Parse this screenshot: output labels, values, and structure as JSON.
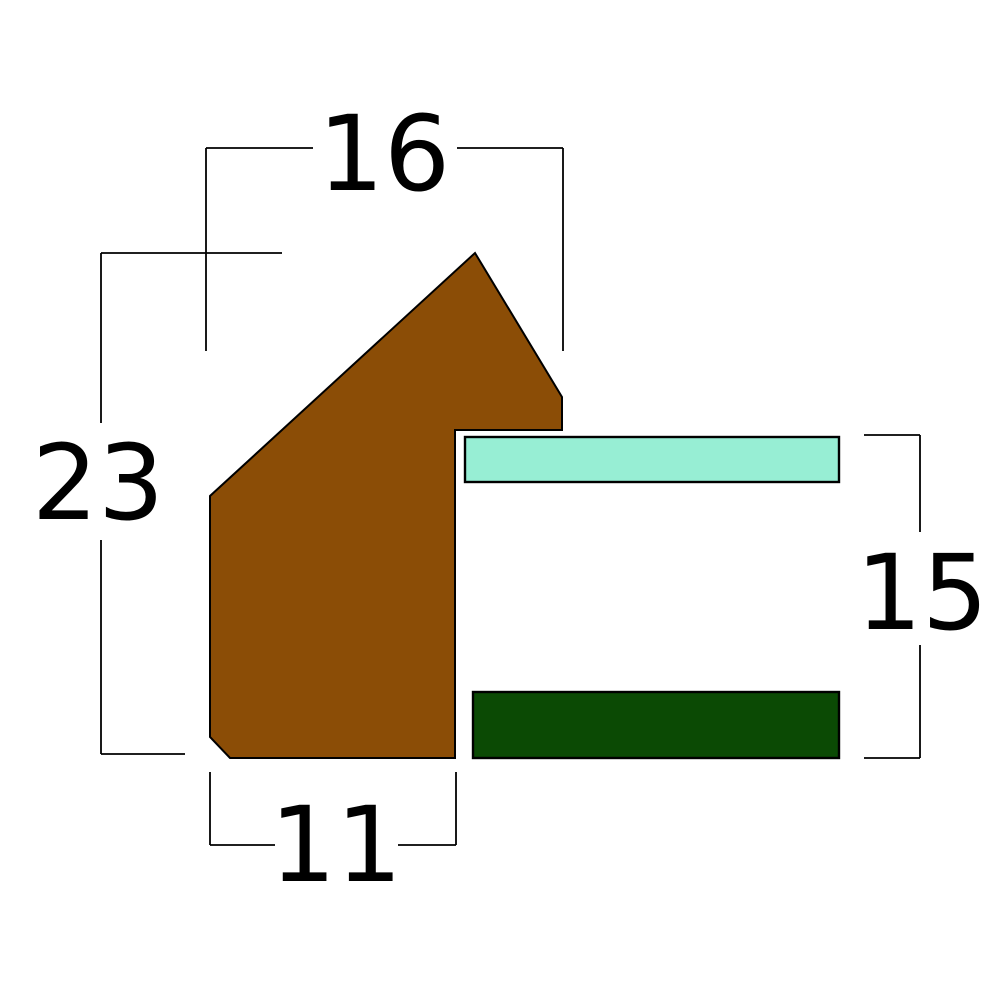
{
  "page": {
    "title": "Frame moulding cross-section with dimensions"
  },
  "canvas": {
    "width": 1000,
    "height": 1000,
    "background": "#ffffff"
  },
  "colors": {
    "outline": "#000000",
    "label_text": "#000000",
    "moulding_fill": "#8B4D06",
    "glass_fill": "#97EED4",
    "backing_fill": "#0B4A04"
  },
  "shapes": [
    {
      "name": "moulding-profile",
      "type": "polygon",
      "fill": "moulding_fill",
      "stroke_width": 2,
      "points": [
        [
          475,
          253
        ],
        [
          562,
          397
        ],
        [
          562,
          430
        ],
        [
          455,
          430
        ],
        [
          455,
          758
        ],
        [
          230,
          758
        ],
        [
          210,
          737
        ],
        [
          210,
          496
        ]
      ]
    },
    {
      "name": "glass-strip",
      "type": "rect",
      "fill": "glass_fill",
      "stroke_width": 2.4,
      "x": 465,
      "y": 437,
      "width": 374,
      "height": 45
    },
    {
      "name": "backing-strip",
      "type": "rect",
      "fill": "backing_fill",
      "stroke_width": 2.4,
      "x": 473,
      "y": 692,
      "width": 366,
      "height": 66
    }
  ],
  "dimensions": [
    {
      "name": "dim-top-width",
      "label": "16",
      "label_x": 384,
      "label_y": 190,
      "segments": [
        [
          206,
          148,
          313,
          148
        ],
        [
          457,
          148,
          563,
          148
        ],
        [
          206,
          148,
          206,
          351
        ],
        [
          563,
          148,
          563,
          351
        ]
      ]
    },
    {
      "name": "dim-left-height",
      "label": "23",
      "label_x": 98,
      "label_y": 519,
      "segments": [
        [
          101,
          253,
          101,
          423
        ],
        [
          101,
          540,
          101,
          754
        ],
        [
          101,
          253,
          282,
          253
        ],
        [
          101,
          754,
          185,
          754
        ]
      ]
    },
    {
      "name": "dim-bottom-width",
      "label": "11",
      "label_x": 336,
      "label_y": 881,
      "segments": [
        [
          210,
          772,
          210,
          845
        ],
        [
          456,
          772,
          456,
          845
        ],
        [
          210,
          845,
          275,
          845
        ],
        [
          398,
          845,
          456,
          845
        ]
      ]
    },
    {
      "name": "dim-right-height",
      "label": "15",
      "label_x": 922,
      "label_y": 629,
      "segments": [
        [
          864,
          435,
          920,
          435
        ],
        [
          864,
          758,
          920,
          758
        ],
        [
          920,
          435,
          920,
          532
        ],
        [
          920,
          645,
          920,
          758
        ]
      ]
    }
  ],
  "dimension_style": {
    "stroke_width": 1.8,
    "font_size": 104
  }
}
